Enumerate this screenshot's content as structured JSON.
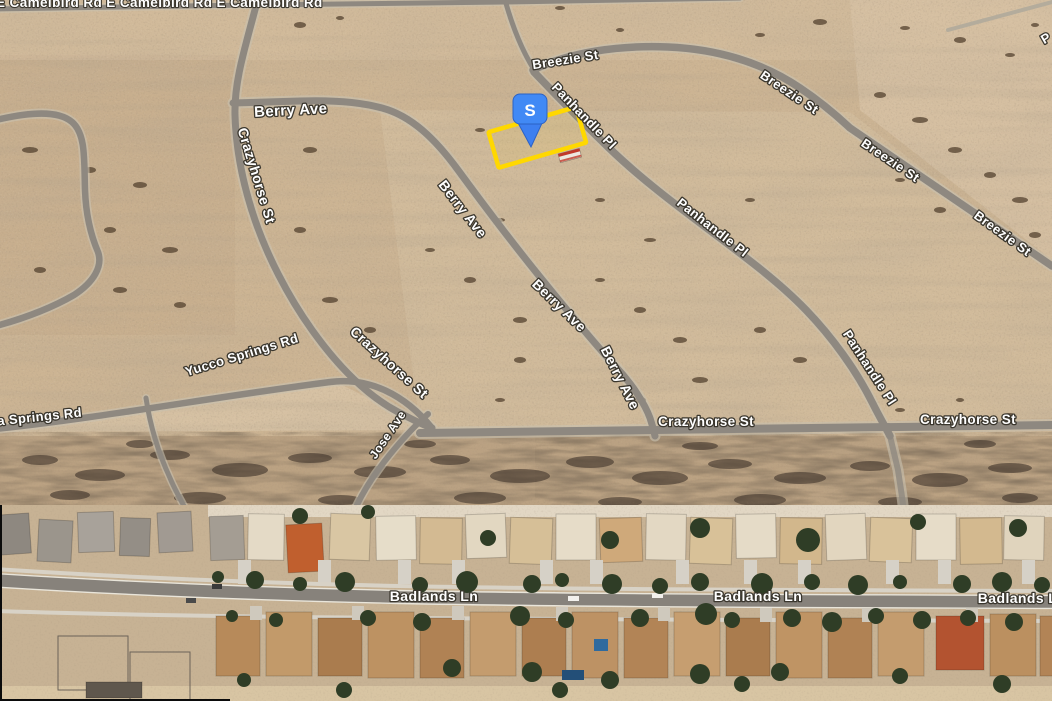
{
  "labels": {
    "camelbird": {
      "text": "E Camelbird Rd E Camelbird Rd E Camelbird Rd"
    },
    "breezie_1": {
      "text": "Breezie St"
    },
    "breezie_2": {
      "text": "Breezie St"
    },
    "breezie_3": {
      "text": "Breezie St"
    },
    "breezie_4": {
      "text": "Breezie St"
    },
    "panhandle_1": {
      "text": "Panhandle Pl"
    },
    "panhandle_2": {
      "text": "Panhandle Pl"
    },
    "panhandle_3": {
      "text": "Panhandle Pl"
    },
    "berry_1": {
      "text": "Berry Ave"
    },
    "berry_2": {
      "text": "Berry Ave"
    },
    "berry_3": {
      "text": "Berry Ave"
    },
    "berry_4": {
      "text": "Berry Ave"
    },
    "crazyhorse_v": {
      "text": "Crazyhorse St"
    },
    "crazyhorse_d": {
      "text": "Crazyhorse St"
    },
    "crazyhorse_h1": {
      "text": "Crazyhorse St"
    },
    "crazyhorse_h2": {
      "text": "Crazyhorse St"
    },
    "yucco": {
      "text": "Yucco Springs Rd"
    },
    "yucca_part": {
      "text": "a Springs Rd"
    },
    "jose": {
      "text": "Jose Ave"
    },
    "badlands_1": {
      "text": "Badlands Ln"
    },
    "badlands_2": {
      "text": "Badlands Ln"
    },
    "badlands_3": {
      "text": "Badlands Ln"
    },
    "fragment_p": {
      "text": "P"
    }
  },
  "marker": {
    "letter": "S",
    "color": "#4189f5"
  },
  "parcel": {
    "outline_color": "#ffd800"
  }
}
